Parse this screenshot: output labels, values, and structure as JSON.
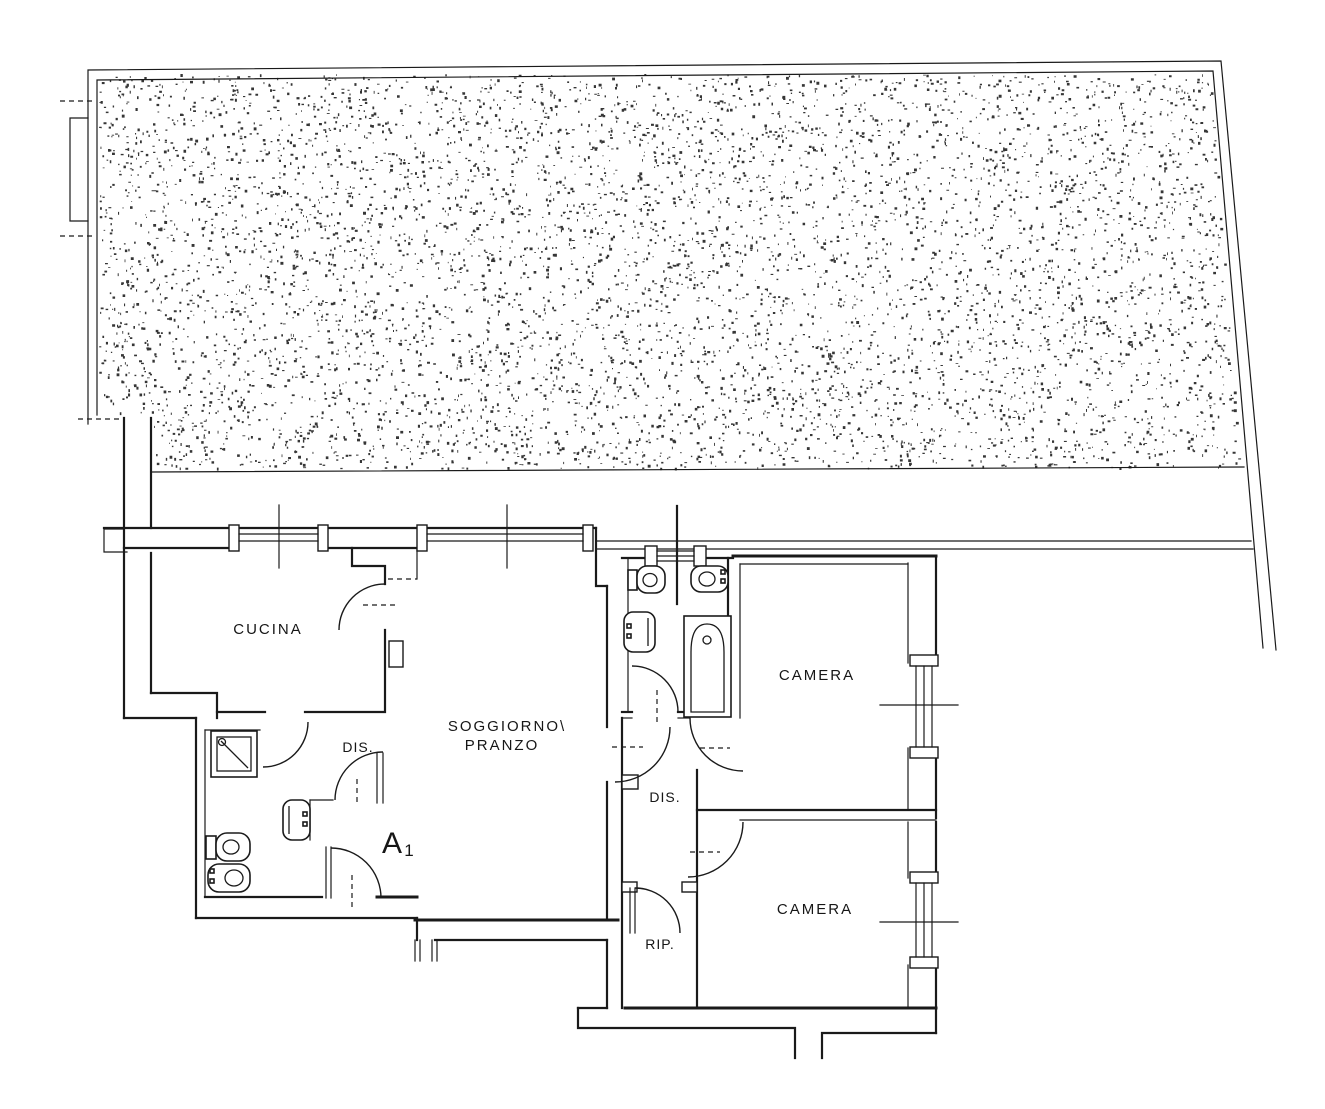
{
  "rooms": {
    "kitchen": "CUCINA",
    "living_line1": "SOGGIORNO\\",
    "living_line2": "PRANZO",
    "hall_left": "DIS.",
    "hall_mid": "DIS.",
    "storage": "RIP.",
    "bedroom1": "CAMERA",
    "bedroom2": "CAMERA"
  },
  "unit": {
    "letter": "A",
    "number": "1"
  },
  "colors": {
    "ink": "#1a1a1a",
    "paper": "#ffffff"
  }
}
